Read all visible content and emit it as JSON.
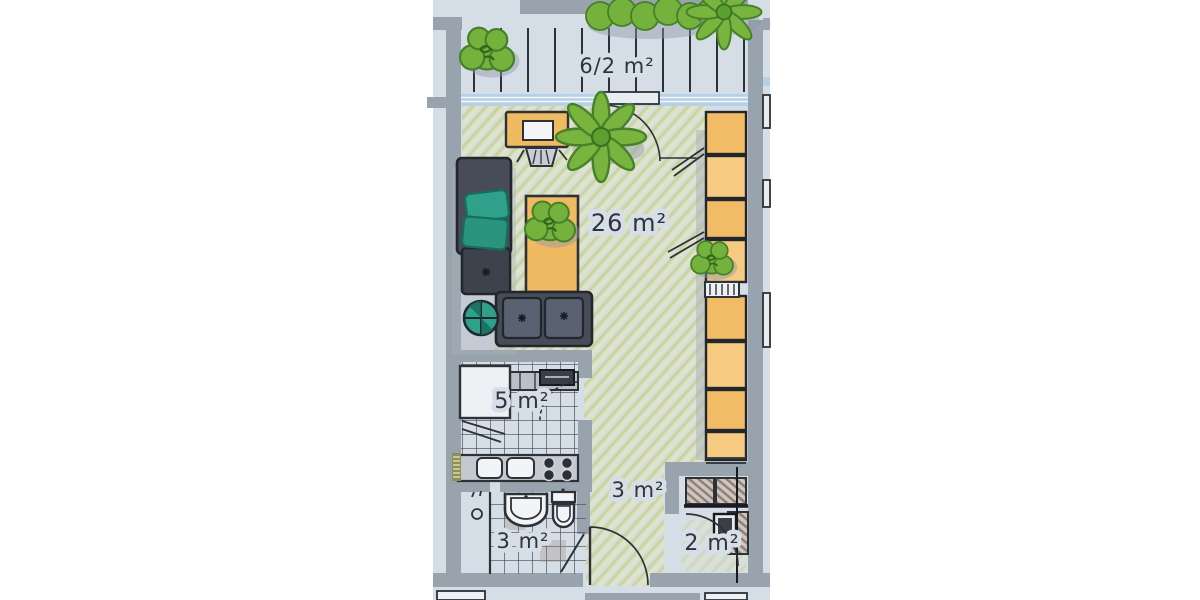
{
  "document": {
    "type": "floor-plan",
    "style": "hand-drawn color sketch, scanned page",
    "orientation": "balcony at top, entrance at bottom"
  },
  "colors": {
    "paper": "#d5dde7",
    "wall_gray": "#99a3ad",
    "accent_orange": "#f0ba62",
    "plant_green": "#79b43f",
    "floor_hatch_green": "#c9d583",
    "floor_hatch_yellow": "#e9e6b0",
    "furniture_dark": "#474c58",
    "cushion_teal": "#2fa08a",
    "window_blue": "#b6d0e4",
    "ink": "#2d3138"
  },
  "rooms": {
    "balcony": {
      "name": "balcony",
      "label": "6/2 m²",
      "features": [
        "wood-decking",
        "shrub",
        "hedge",
        "palm-plant"
      ]
    },
    "living_room": {
      "name": "living room",
      "label": "26 m²",
      "features": [
        "desk",
        "desk-chair",
        "potted-plant",
        "corner-sofa",
        "teal-cushions",
        "round-pouf",
        "rug-with-plant",
        "wardrobe-wall",
        "balcony-door"
      ]
    },
    "kitchen": {
      "name": "kitchen",
      "label": "5 m²",
      "features": [
        "refrigerator",
        "worktop",
        "double-sink",
        "stove-four-burners",
        "radiator",
        "tiled-floor",
        "door-arc"
      ]
    },
    "bathroom": {
      "name": "bathroom",
      "label": "3 m²",
      "features": [
        "shower",
        "washbasin",
        "toilet",
        "tiled-floor",
        "door-leaf"
      ]
    },
    "hallway": {
      "name": "hallway",
      "label": "3 m²",
      "features": [
        "entrance-door-arc"
      ]
    },
    "storage": {
      "name": "storage room",
      "label": "2 m²",
      "features": [
        "shelves",
        "boiler",
        "door-arc"
      ]
    }
  }
}
